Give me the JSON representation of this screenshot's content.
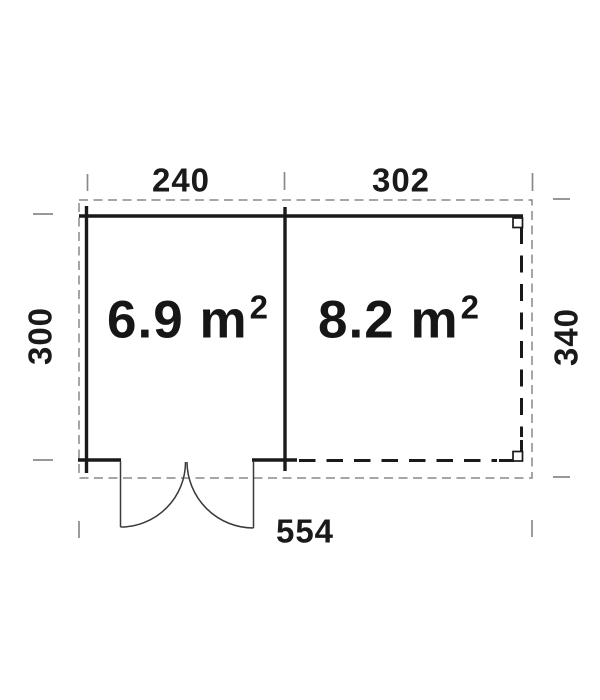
{
  "plan": {
    "dimensions": {
      "top_left": "240",
      "top_right": "302",
      "left": "300",
      "right": "340",
      "bottom": "554"
    },
    "rooms": [
      {
        "area_text": "6.9 m",
        "area_sup": "2"
      },
      {
        "area_text": "8.2 m",
        "area_sup": "2"
      }
    ],
    "colors": {
      "walls": "#1a1a1a",
      "roof_outline": "#888888",
      "dimension_ticks": "#8a8a8a",
      "door": "#3a3a3a",
      "background": "#ffffff"
    }
  }
}
